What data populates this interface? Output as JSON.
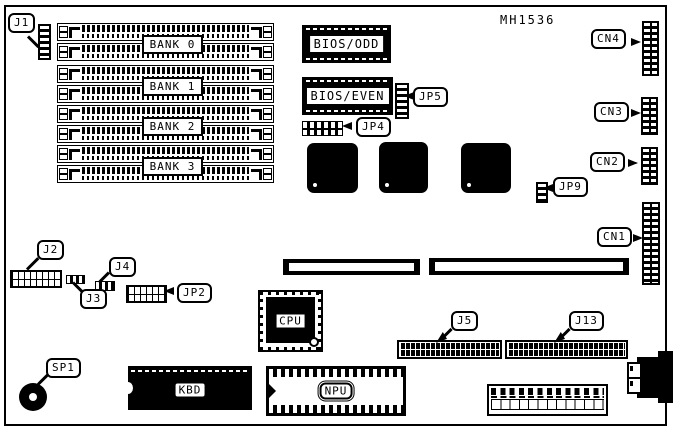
{
  "diagram": {
    "part_number": "MH1536"
  },
  "labels": {
    "j1": "J1",
    "j2": "J2",
    "j3": "J3",
    "j4": "J4",
    "j5": "J5",
    "j13": "J13",
    "jp2": "JP2",
    "jp4": "JP4",
    "jp5": "JP5",
    "jp9": "JP9",
    "cn1": "CN1",
    "cn2": "CN2",
    "cn3": "CN3",
    "cn4": "CN4",
    "sp1": "SP1",
    "bank0": "BANK 0",
    "bank1": "BANK 1",
    "bank2": "BANK 2",
    "bank3": "BANK 3",
    "bios_odd": "BIOS/ODD",
    "bios_even": "BIOS/EVEN",
    "cpu": "CPU",
    "kbd": "KBD",
    "npu": "NPU"
  },
  "colors": {
    "ink": "#000000",
    "paper": "#ffffff"
  }
}
